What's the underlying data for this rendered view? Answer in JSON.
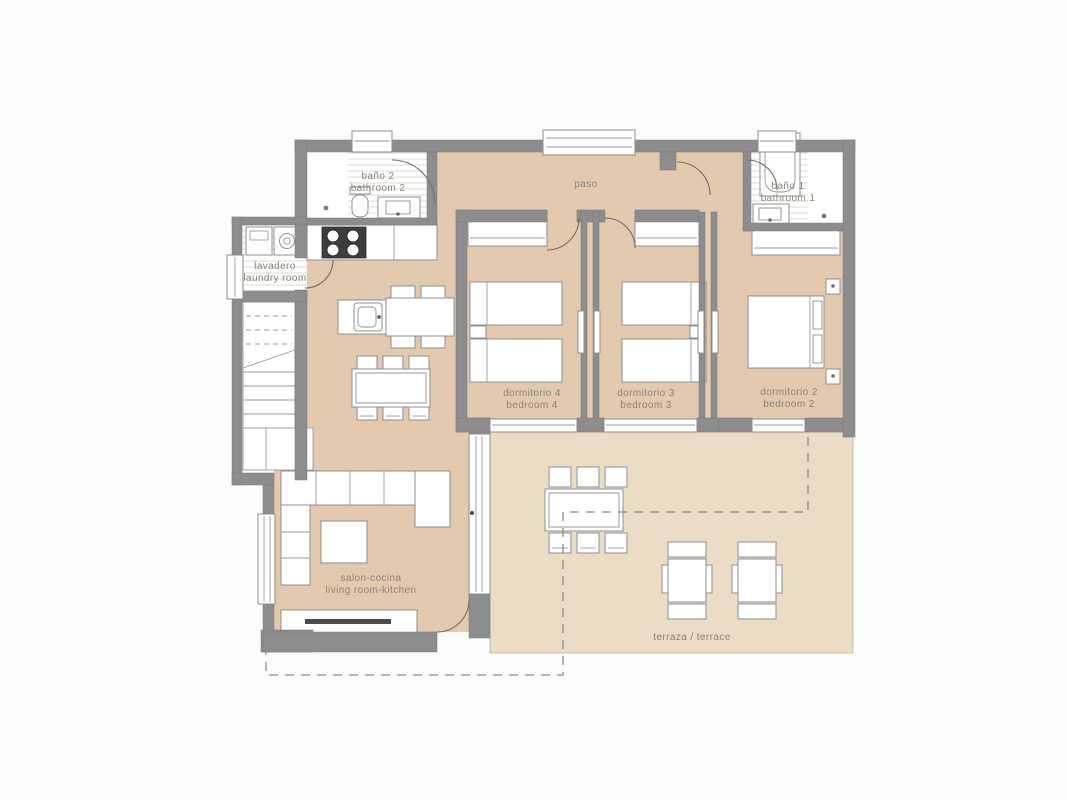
{
  "floorplan": {
    "rooms": {
      "bano2": {
        "es": "baño 2",
        "en": "bathroom 2"
      },
      "paso": {
        "es": "paso"
      },
      "bano1": {
        "es": "baño 1",
        "en": "bathroom 1"
      },
      "lavadero": {
        "es": "lavadero",
        "en": "laundry room"
      },
      "dormitorio4": {
        "es": "dormitorio 4",
        "en": "bedroom 4"
      },
      "dormitorio3": {
        "es": "dormitorio 3",
        "en": "bedroom 3"
      },
      "dormitorio2": {
        "es": "dormitorio 2",
        "en": "bedroom 2"
      },
      "salon": {
        "es": "salon-cocina",
        "en": "living room-kitchen"
      },
      "terraza": {
        "es": "terraza / terrace"
      }
    },
    "colors": {
      "background": "#fcfcfa",
      "wall": "#8d8d8d",
      "floor": "#e3c9ad",
      "terrace": "#ebdcc5",
      "tile_stripe": "#d9d8d2"
    }
  }
}
